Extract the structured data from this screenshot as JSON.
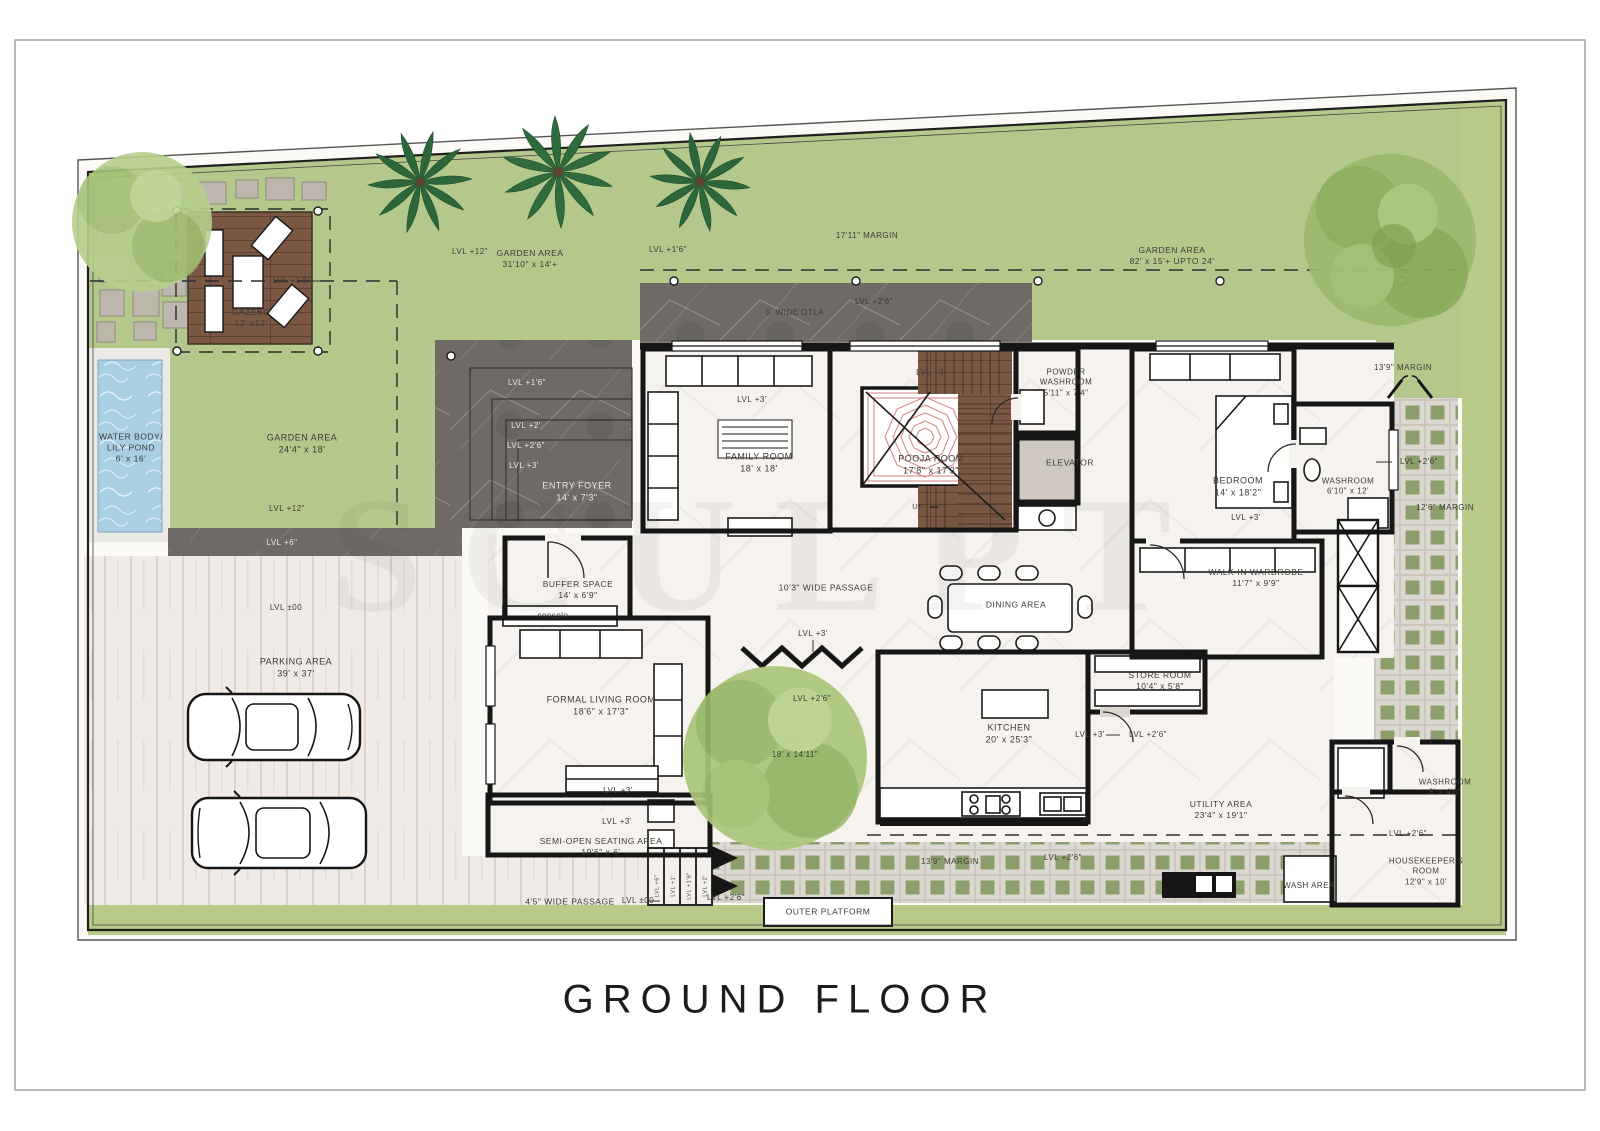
{
  "title": {
    "text": "GROUND FLOOR"
  },
  "watermark": "SCULPT",
  "labels": [
    {
      "id": "lvl-gazebo",
      "text": "LVL +1'6\"",
      "x": 292,
      "y": 281,
      "size": 8
    },
    {
      "id": "gazebo",
      "text": "GAZEBO\n12' x12'",
      "x": 251,
      "y": 318,
      "size": 8.5
    },
    {
      "id": "water-body",
      "text": "WATER BODY/\nLILY POND\n6' x 16'",
      "x": 131,
      "y": 448,
      "size": 8.5
    },
    {
      "id": "garden-area-left",
      "text": "GARDEN AREA\n24'4\" x 18'",
      "x": 302,
      "y": 444
    },
    {
      "id": "lvl12-left",
      "text": "LVL +12\"",
      "x": 287,
      "y": 509,
      "size": 8
    },
    {
      "id": "lvl6-walkway",
      "text": "LVL +6\"",
      "x": 282,
      "y": 543,
      "size": 8,
      "light": true
    },
    {
      "id": "lvl00-parking",
      "text": "LVL ±00",
      "x": 286,
      "y": 608,
      "size": 8
    },
    {
      "id": "parking",
      "text": "PARKING AREA\n39' x 37'",
      "x": 296,
      "y": 668
    },
    {
      "id": "lvl12-top",
      "text": "LVL +12\"",
      "x": 470,
      "y": 252,
      "size": 8
    },
    {
      "id": "garden-area-top",
      "text": "GARDEN AREA\n31'10\" x 14'+",
      "x": 530,
      "y": 259,
      "size": 8.5
    },
    {
      "id": "lvl16-top",
      "text": "LVL +1'6\"",
      "x": 668,
      "y": 250,
      "size": 8
    },
    {
      "id": "margin-1711",
      "text": "17'11\" MARGIN",
      "x": 867,
      "y": 236,
      "size": 8
    },
    {
      "id": "otla",
      "text": "5' WIDE OTLA",
      "x": 795,
      "y": 313,
      "size": 8
    },
    {
      "id": "lvl26-otla",
      "text": "LVL +2'6\"",
      "x": 874,
      "y": 302,
      "size": 8
    },
    {
      "id": "garden-area-right",
      "text": "GARDEN AREA\n82' x 15'+ UPTO 24'",
      "x": 1172,
      "y": 256,
      "size": 8.5
    },
    {
      "id": "margin-139-right",
      "text": "13'9\" MARGIN",
      "x": 1403,
      "y": 368,
      "size": 8
    },
    {
      "id": "lvl16-steps",
      "text": "LVL +1'6\"",
      "x": 527,
      "y": 383,
      "size": 8,
      "light": true
    },
    {
      "id": "lvl2-steps",
      "text": "LVL +2'",
      "x": 526,
      "y": 426,
      "size": 8,
      "light": true
    },
    {
      "id": "lvl26-steps",
      "text": "LVL +2'6\"",
      "x": 526,
      "y": 446,
      "size": 8,
      "light": true
    },
    {
      "id": "lvl3-steps",
      "text": "LVL +3'",
      "x": 524,
      "y": 466,
      "size": 8,
      "light": true
    },
    {
      "id": "entry-foyer",
      "text": "ENTRY FOYER\n14' x 7'3\"",
      "x": 577,
      "y": 492,
      "light": true
    },
    {
      "id": "lvl3-family",
      "text": "LVL +3'",
      "x": 752,
      "y": 400,
      "size": 8
    },
    {
      "id": "family-room",
      "text": "FAMILY ROOM\n18' x 18'",
      "x": 759,
      "y": 463
    },
    {
      "id": "lvl3-pooja",
      "text": "LVL +3",
      "x": 930,
      "y": 373,
      "size": 8
    },
    {
      "id": "pooja-room",
      "text": "POOJA ROOM\n17'8\" x 17'3\"",
      "x": 931,
      "y": 465
    },
    {
      "id": "up",
      "text": "UP",
      "x": 918,
      "y": 507,
      "size": 7.5
    },
    {
      "id": "powder-washroom",
      "text": "POWDER\nWASHROOM\n5'11\" x 7'4\"",
      "x": 1066,
      "y": 383,
      "size": 8
    },
    {
      "id": "elevator",
      "text": "ELEVATOR",
      "x": 1070,
      "y": 463,
      "size": 8.5
    },
    {
      "id": "bedroom",
      "text": "BEDROOM\n14' x 18'2\"",
      "x": 1238,
      "y": 487
    },
    {
      "id": "lvl3-bedroom",
      "text": "LVL +3'",
      "x": 1246,
      "y": 518,
      "size": 8
    },
    {
      "id": "washroom-bed",
      "text": "WASHROOM\n6'10\" x 12'",
      "x": 1348,
      "y": 487,
      "size": 8
    },
    {
      "id": "lvl26-margin-right",
      "text": "LVL +2'6\"",
      "x": 1419,
      "y": 462,
      "size": 8
    },
    {
      "id": "margin-126",
      "text": "12'6\" MARGIN",
      "x": 1445,
      "y": 508,
      "size": 8
    },
    {
      "id": "wardrobe",
      "text": "WALK-IN WARDROBE\n11'7\" x 9'9\"",
      "x": 1256,
      "y": 578,
      "size": 8.5
    },
    {
      "id": "passage",
      "text": "10'3\" WIDE PASSAGE",
      "x": 826,
      "y": 588,
      "size": 8.5
    },
    {
      "id": "dining",
      "text": "DINING AREA",
      "x": 1016,
      "y": 605,
      "size": 8.5
    },
    {
      "id": "lvl3-court",
      "text": "LVL +3'",
      "x": 813,
      "y": 634,
      "size": 8
    },
    {
      "id": "lvl26-court",
      "text": "LVL +2'6\"",
      "x": 812,
      "y": 699,
      "size": 8
    },
    {
      "id": "court-size",
      "text": "18' x 14'11\"",
      "x": 795,
      "y": 755,
      "size": 8
    },
    {
      "id": "buffer",
      "text": "BUFFER SPACE\n14' x 6'9\"",
      "x": 578,
      "y": 590,
      "size": 8.5
    },
    {
      "id": "console",
      "text": "console",
      "x": 553,
      "y": 616,
      "size": 8
    },
    {
      "id": "formal-living",
      "text": "FORMAL LIVING ROOM\n18'6\" x 17'3\"",
      "x": 601,
      "y": 706
    },
    {
      "id": "lvl3-living",
      "text": "LVL +3'",
      "x": 618,
      "y": 791,
      "size": 8
    },
    {
      "id": "lvl3-semi",
      "text": "LVL +3'",
      "x": 617,
      "y": 822,
      "size": 8
    },
    {
      "id": "semi-open",
      "text": "SEMI-OPEN SEATING AREA\n19'6\" x 6'",
      "x": 601,
      "y": 847,
      "size": 8.5
    },
    {
      "id": "kitchen",
      "text": "KITCHEN\n20' x 25'3\"",
      "x": 1009,
      "y": 734
    },
    {
      "id": "lvl3-kitchen",
      "text": "LVL +3'",
      "x": 1090,
      "y": 735,
      "size": 8
    },
    {
      "id": "lvl26-kitchen",
      "text": "LVL +2'6\"",
      "x": 1148,
      "y": 735,
      "size": 8
    },
    {
      "id": "store-room",
      "text": "STORE ROOM\n10'4\" x 5'8\"",
      "x": 1160,
      "y": 681,
      "size": 8.5
    },
    {
      "id": "utility",
      "text": "UTILITY AREA\n23'4\" x 19'1\"",
      "x": 1221,
      "y": 810,
      "size": 8.5
    },
    {
      "id": "margin-139-bottom",
      "text": "13'9\" MARGIN",
      "x": 950,
      "y": 862,
      "size": 8
    },
    {
      "id": "lvl26-bottom",
      "text": "LVL +2'6\"",
      "x": 1063,
      "y": 858,
      "size": 8
    },
    {
      "id": "washroom-hk",
      "text": "WASHROOM\n8' x 4'6\"",
      "x": 1445,
      "y": 788,
      "size": 8
    },
    {
      "id": "lvl26-hk",
      "text": "LVL +2'6\"",
      "x": 1408,
      "y": 834,
      "size": 8
    },
    {
      "id": "housekeeper",
      "text": "HOUSEKEEPER'S\nROOM\n12'9\" x 10'",
      "x": 1426,
      "y": 872,
      "size": 8
    },
    {
      "id": "wash-area",
      "text": "WASH AREA",
      "x": 1309,
      "y": 886,
      "size": 8
    },
    {
      "id": "outer-platform",
      "text": "OUTER PLATFORM",
      "x": 828,
      "y": 912,
      "size": 8.5
    },
    {
      "id": "passage-45",
      "text": "4'5\" WIDE PASSAGE",
      "x": 570,
      "y": 902,
      "size": 8.5
    },
    {
      "id": "lvl00-passage",
      "text": "LVL ±00",
      "x": 638,
      "y": 901,
      "size": 8
    },
    {
      "id": "lvl26-steps-out",
      "text": "LVL +2'6\"",
      "x": 726,
      "y": 898,
      "size": 8
    },
    {
      "id": "step-a",
      "text": "LVL +6\"",
      "x": 658,
      "y": 886,
      "size": 5.5,
      "rot": -90
    },
    {
      "id": "step-b",
      "text": "LVL +1'",
      "x": 674,
      "y": 886,
      "size": 5.5,
      "rot": -90
    },
    {
      "id": "step-c",
      "text": "LVL +1'6\"",
      "x": 690,
      "y": 886,
      "size": 5.5,
      "rot": -90
    },
    {
      "id": "step-d",
      "text": "LVL +2'",
      "x": 706,
      "y": 886,
      "size": 5.5,
      "rot": -90
    }
  ]
}
